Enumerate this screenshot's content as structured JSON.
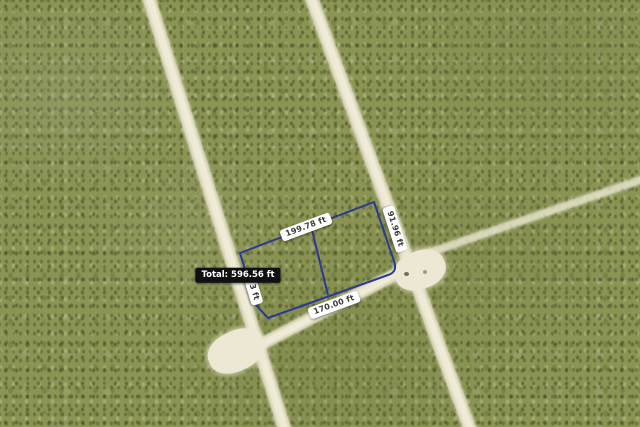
{
  "map": {
    "type": "aerial-satellite-view",
    "scene": "vacant land parcels separated by unpaved sand roads through green scrub vegetation",
    "measurement": {
      "tool": "distance-measurement-overlay",
      "line_color": "#2b3896",
      "segment_labels": {
        "top": "199.78 ft",
        "right": "91.96 ft",
        "bottom": "170.00 ft",
        "left_partial": "3 ft"
      },
      "total": "Total: 596.56 ft"
    },
    "colors": {
      "vegetation": "#8b9453",
      "road": "#efecd8",
      "label_bg": "#ffffff",
      "label_text": "#3a3a3a",
      "total_bg": "#101010",
      "total_text": "#ffffff"
    }
  }
}
